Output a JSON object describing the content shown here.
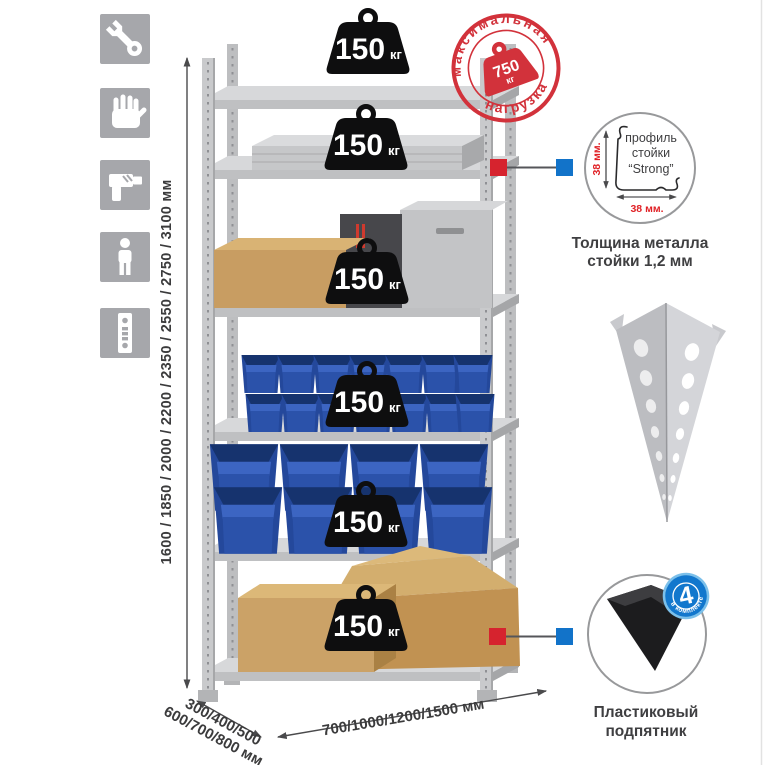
{
  "canvas": {
    "width": 765,
    "height": 765,
    "background": "#ffffff"
  },
  "assembly_icons": [
    {
      "name": "wrench-icon"
    },
    {
      "name": "gloves-icon"
    },
    {
      "name": "drill-icon"
    },
    {
      "name": "person-icon"
    },
    {
      "name": "perforated-post-icon"
    }
  ],
  "height_dimension": {
    "label": "1600 / 1850 / 2000 / 2200 / 2350 / 2550 / 2750 / 3100 мм"
  },
  "rack": {
    "shelf_count": 6,
    "shelves": [
      {
        "load": "150",
        "unit": "кг",
        "contents": "empty"
      },
      {
        "load": "150",
        "unit": "кг",
        "contents": "aluminum-case"
      },
      {
        "load": "150",
        "unit": "кг",
        "contents": "cardboard-box-and-metal-cases"
      },
      {
        "load": "150",
        "unit": "кг",
        "contents": "small-blue-bins"
      },
      {
        "load": "150",
        "unit": "кг",
        "contents": "large-blue-bins"
      },
      {
        "load": "150",
        "unit": "кг",
        "contents": "cardboard-boxes"
      }
    ]
  },
  "max_load_stamp": {
    "arc_top": "максимальная",
    "arc_bottom": "нагрузка",
    "value": "750",
    "unit": "кг"
  },
  "profile_detail": {
    "text_line1": "профиль",
    "text_line2": "стойки",
    "text_line3": "“Strong”",
    "dim_vertical": "38 мм.",
    "dim_horizontal": "38 мм.",
    "caption_line1": "Толщина металла",
    "caption_line2": "стойки 1,2 мм"
  },
  "post_image": {
    "name": "perforated-angle-post"
  },
  "foot_detail": {
    "badge_value": "4",
    "badge_arc_text": "в комплекте",
    "caption_line1": "Пластиковый",
    "caption_line2": "подпятник"
  },
  "depth_dimension": {
    "line1": "300/400/500",
    "line2": "600/700/800 мм"
  },
  "width_dimension": {
    "label": "700/1000/1200/1500 мм"
  },
  "colors": {
    "stamp_red": "#d2323b",
    "marker_red": "#d6232e",
    "marker_blue": "#1273c9",
    "bin_blue": "#2b52aa",
    "metal_gray": "#c9cacc",
    "icon_gray": "#a6a7ab",
    "badge_black": "#0e0e0f",
    "text_dark": "#3b3b3c",
    "dim_red": "#e02025"
  }
}
